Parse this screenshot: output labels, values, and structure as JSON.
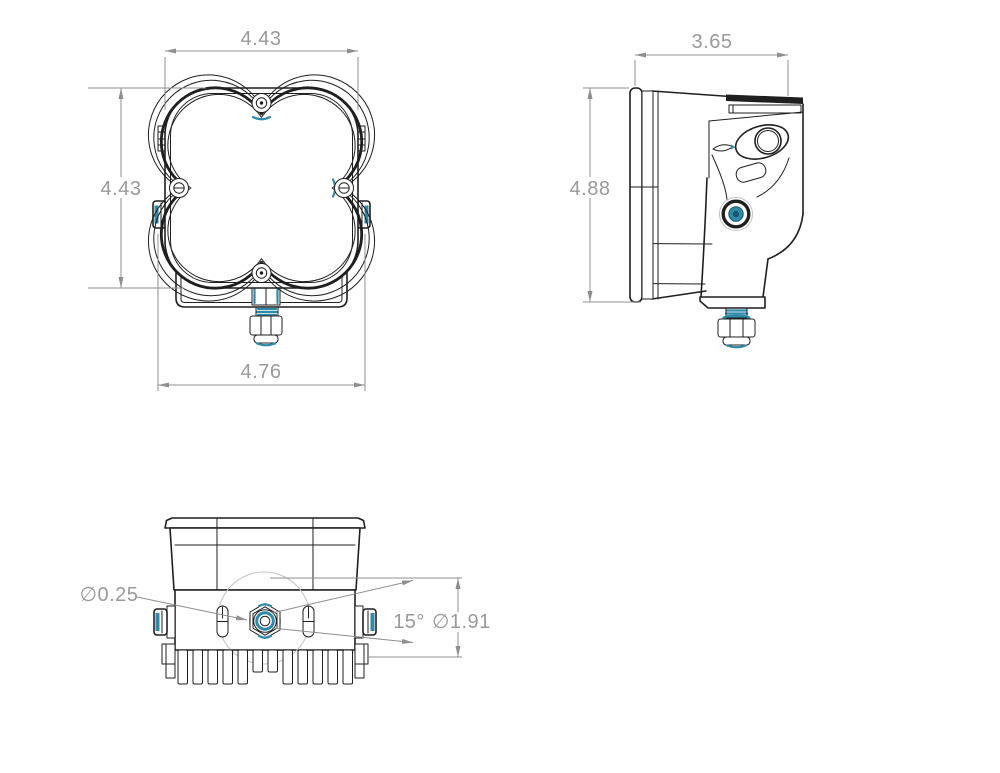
{
  "drawing": {
    "views": {
      "front": {
        "width": "4.43",
        "height": "4.43",
        "overall_width": "4.76"
      },
      "side": {
        "depth": "3.65",
        "height": "4.88"
      },
      "bottom": {
        "slot_diameter": "∅0.25",
        "tilt_angle": "15°",
        "knob_diameter": "∅1.91"
      }
    },
    "colors": {
      "line": "#1f1f1f",
      "dim": "#9a9a9a",
      "dimline": "#8f8f8f",
      "accent": "#2e8aa8",
      "accent-dark": "#14586e",
      "faint": "#c2c2c2"
    }
  }
}
